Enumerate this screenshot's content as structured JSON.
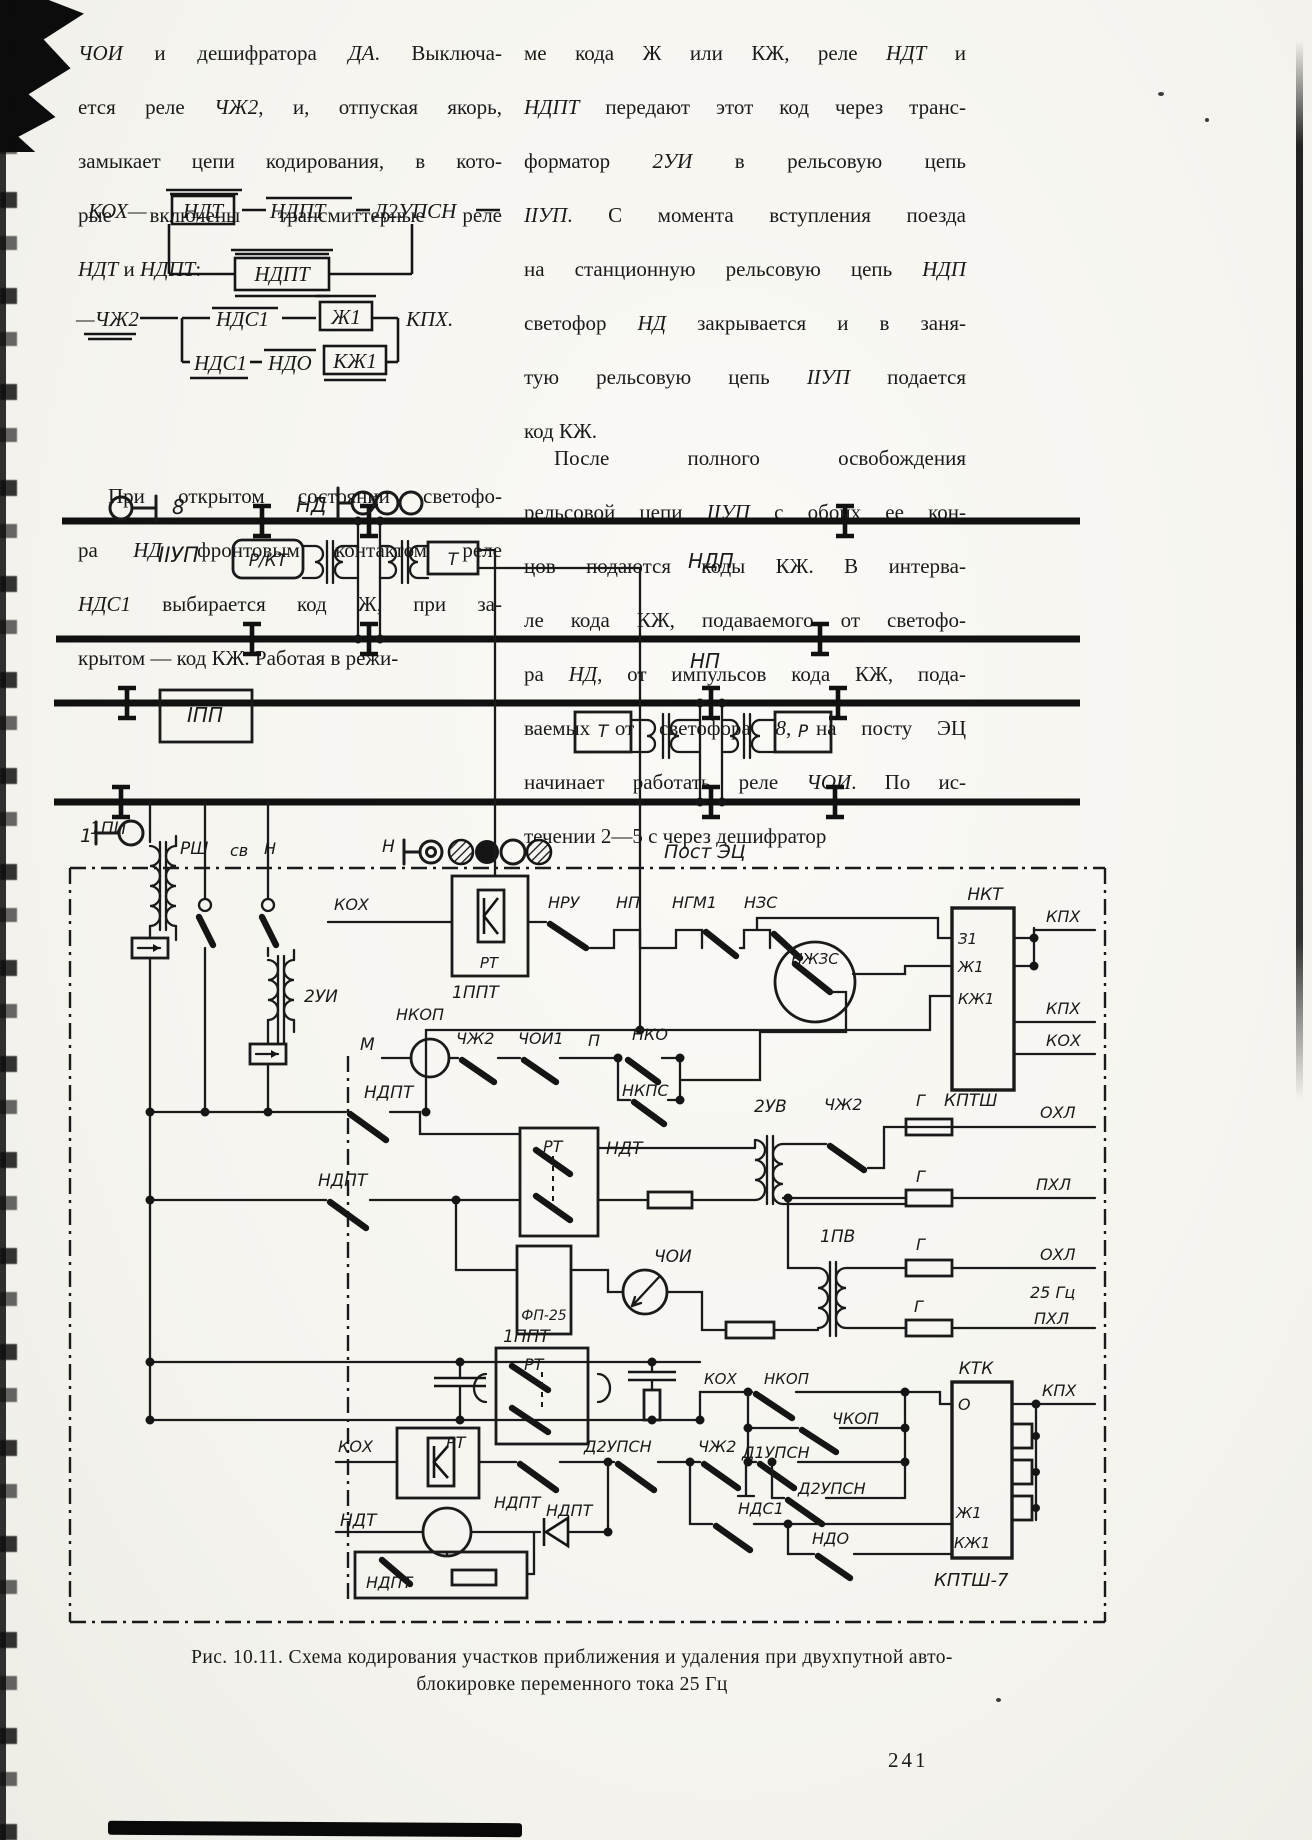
{
  "page": {
    "number": "241"
  },
  "caption": {
    "line1": "Рис. 10.11. Схема кодирования участков приближения и удаления при двухпутной авто-",
    "line2": "блокировке переменного тока 25 Гц"
  },
  "text": {
    "left": {
      "para1": [
        [
          [
            "ЧОИ",
            1
          ],
          [
            " и дешифратора ",
            0
          ],
          [
            "ДА",
            1
          ],
          [
            ". Выключа-",
            0
          ]
        ],
        [
          [
            "ется реле ",
            0
          ],
          [
            "ЧЖ2",
            1
          ],
          [
            ", и, отпуская якорь,",
            0
          ]
        ],
        [
          [
            "замыкает цепи кодирования, в кото-",
            0
          ]
        ],
        [
          [
            "рые включены трансмиттерные реле",
            0
          ]
        ],
        [
          [
            "НДТ",
            1
          ],
          [
            " и ",
            0
          ],
          [
            "НДПТ",
            1
          ],
          [
            ":",
            0
          ]
        ]
      ],
      "para2": [
        [
          [
            "При открытом состоянии светофо-",
            0
          ]
        ],
        [
          [
            "ра ",
            0
          ],
          [
            "НД",
            1
          ],
          [
            " фронтовым контактом реле",
            0
          ]
        ],
        [
          [
            "НДС1",
            1
          ],
          [
            " выбирается код Ж, при за-",
            0
          ]
        ],
        [
          [
            "крытом — код КЖ. Работая в режи-",
            0
          ]
        ]
      ]
    },
    "right": {
      "para1": [
        [
          [
            "ме кода Ж или КЖ, реле ",
            0
          ],
          [
            "НДТ",
            1
          ],
          [
            " и",
            0
          ]
        ],
        [
          [
            "НДПТ",
            1
          ],
          [
            " передают этот код через транс-",
            0
          ]
        ],
        [
          [
            "форматор ",
            0
          ],
          [
            "2УИ",
            1
          ],
          [
            " в рельсовую цепь",
            0
          ]
        ],
        [
          [
            "IIУП",
            1
          ],
          [
            ". С момента вступления поезда",
            0
          ]
        ],
        [
          [
            "на станционную рельсовую цепь ",
            0
          ],
          [
            "НДП",
            1
          ]
        ],
        [
          [
            "светофор ",
            0
          ],
          [
            "НД",
            1
          ],
          [
            " закрывается и в заня-",
            0
          ]
        ],
        [
          [
            "тую рельсовую цепь ",
            0
          ],
          [
            "IIУП",
            1
          ],
          [
            " подается",
            0
          ]
        ],
        [
          [
            "код КЖ.",
            0
          ]
        ]
      ],
      "para2": [
        [
          [
            "После полного освобождения",
            0
          ]
        ],
        [
          [
            "рельсовой цепи ",
            0
          ],
          [
            "IIУП",
            1
          ],
          [
            " с обоих ее кон-",
            0
          ]
        ],
        [
          [
            "цов подаются коды КЖ. В интерва-",
            0
          ]
        ],
        [
          [
            "ле кода КЖ, подаваемого от светофо-",
            0
          ]
        ],
        [
          [
            "ра ",
            0
          ],
          [
            "НД",
            1
          ],
          [
            ", от импульсов кода КЖ, пода-",
            0
          ]
        ],
        [
          [
            "ваемых от светофора ",
            0
          ],
          [
            "8",
            1
          ],
          [
            ", на посту ЭЦ",
            0
          ]
        ],
        [
          [
            "начинает работать реле ",
            0
          ],
          [
            "ЧОИ",
            1
          ],
          [
            ". По ис-",
            0
          ]
        ],
        [
          [
            "течении 2—5 с через дешифратор",
            0
          ]
        ]
      ]
    }
  },
  "formula": {
    "labels": [
      {
        "n": "f-kox",
        "t": "КОХ—",
        "x": 16,
        "y": 32,
        "s": 21
      },
      {
        "n": "f-ndt",
        "t": "НДТ",
        "x": 131,
        "y": 32,
        "s": 21,
        "a": "middle"
      },
      {
        "n": "f-ndpt",
        "t": "НДПТ",
        "x": 198,
        "y": 32,
        "s": 21
      },
      {
        "n": "f-d2upsn",
        "t": "Д2УПСН",
        "x": 302,
        "y": 32,
        "s": 21
      },
      {
        "n": "f-ndpt2",
        "t": "НДПТ",
        "x": 210,
        "y": 95,
        "s": 21,
        "a": "middle"
      },
      {
        "n": "f-chzh2",
        "t": "—ЧЖ2",
        "x": 4,
        "y": 140,
        "s": 21
      },
      {
        "n": "f-nds1",
        "t": "НДС1",
        "x": 144,
        "y": 140,
        "s": 21
      },
      {
        "n": "f-zh1",
        "t": "Ж1",
        "x": 274,
        "y": 138,
        "s": 21,
        "a": "middle"
      },
      {
        "n": "f-kpx",
        "t": "КПХ.",
        "x": 334,
        "y": 140,
        "s": 21
      },
      {
        "n": "f-nds1b",
        "t": "НДС1",
        "x": 122,
        "y": 184,
        "s": 21
      },
      {
        "n": "f-ndo",
        "t": "НДО",
        "x": 196,
        "y": 184,
        "s": 21
      },
      {
        "n": "f-kzh1",
        "t": "КЖ1",
        "x": 283,
        "y": 182,
        "s": 21,
        "a": "middle"
      }
    ]
  },
  "diagram": {
    "labels": [
      {
        "n": "signal-8-number",
        "t": "8",
        "x": 172,
        "y": 514,
        "s": 20
      },
      {
        "n": "signal-nd-name",
        "t": "НД",
        "x": 296,
        "y": 512,
        "s": 20
      },
      {
        "n": "track-2up-label",
        "t": "IIУП",
        "x": 158,
        "y": 562,
        "s": 21
      },
      {
        "n": "box-rkt-label",
        "t": "Р/КТ",
        "x": 268,
        "y": 566,
        "s": 17,
        "a": "middle"
      },
      {
        "n": "box-t2-label",
        "t": "Т",
        "x": 453,
        "y": 565,
        "s": 17,
        "a": "middle"
      },
      {
        "n": "track-ndp-label",
        "t": "НДП",
        "x": 688,
        "y": 568,
        "s": 20
      },
      {
        "n": "track-1pp-label",
        "t": "IПП",
        "x": 205,
        "y": 722,
        "s": 20,
        "a": "middle"
      },
      {
        "n": "box-t1-label",
        "t": "Т",
        "x": 603,
        "y": 737,
        "s": 17,
        "a": "middle"
      },
      {
        "n": "box-r1-label",
        "t": "Р",
        "x": 803,
        "y": 737,
        "s": 17,
        "a": "middle"
      },
      {
        "n": "track-np-label",
        "t": "НП",
        "x": 690,
        "y": 668,
        "s": 20
      },
      {
        "n": "signal-1-number",
        "t": "1",
        "x": 80,
        "y": 842,
        "s": 19
      },
      {
        "n": "cable-rsh-label",
        "t": "РШ",
        "x": 180,
        "y": 854,
        "s": 17
      },
      {
        "n": "cable-sv-label",
        "t": "св",
        "x": 230,
        "y": 856,
        "s": 16
      },
      {
        "n": "cable-n-label",
        "t": "Н",
        "x": 264,
        "y": 854,
        "s": 16
      },
      {
        "n": "signal-n-name",
        "t": "Н",
        "x": 382,
        "y": 852,
        "s": 17
      },
      {
        "n": "post-ec-label",
        "t": "Пост ЭЦ",
        "x": 664,
        "y": 858,
        "s": 19
      },
      {
        "n": "transformer-1pi-label",
        "t": "1ПИ",
        "x": 90,
        "y": 834,
        "s": 17
      },
      {
        "n": "transformer-2ui-label",
        "t": "2УИ",
        "x": 304,
        "y": 1002,
        "s": 17
      },
      {
        "n": "wire-kox-label",
        "t": "КОХ",
        "x": 334,
        "y": 910,
        "s": 16
      },
      {
        "n": "box-rt-label",
        "t": "РТ",
        "x": 489,
        "y": 968,
        "s": 15,
        "a": "middle"
      },
      {
        "n": "box-1ppt-label",
        "t": "1ППТ",
        "x": 452,
        "y": 998,
        "s": 17
      },
      {
        "n": "contact-nru-label",
        "t": "НРУ",
        "x": 548,
        "y": 908,
        "s": 16
      },
      {
        "n": "contact-np-label",
        "t": "НП",
        "x": 616,
        "y": 908,
        "s": 16
      },
      {
        "n": "contact-ngm1-label",
        "t": "НГМ1",
        "x": 672,
        "y": 908,
        "s": 16
      },
      {
        "n": "contact-nzs-label",
        "t": "НЗС",
        "x": 744,
        "y": 908,
        "s": 16
      },
      {
        "n": "relay-nzhzs-label",
        "t": "НЖЗС",
        "x": 815,
        "y": 964,
        "s": 15,
        "a": "middle"
      },
      {
        "n": "block-nkt-label",
        "t": "НКТ",
        "x": 985,
        "y": 900,
        "s": 17,
        "a": "middle"
      },
      {
        "n": "terminal-z1-label",
        "t": "З1",
        "x": 958,
        "y": 944,
        "s": 15
      },
      {
        "n": "terminal-zh1-label",
        "t": "Ж1",
        "x": 958,
        "y": 972,
        "s": 15
      },
      {
        "n": "terminal-kzh1-label",
        "t": "КЖ1",
        "x": 958,
        "y": 1004,
        "s": 15
      },
      {
        "n": "wire-kpx1-label",
        "t": "КПХ",
        "x": 1046,
        "y": 922,
        "s": 16
      },
      {
        "n": "wire-kpx2-label",
        "t": "КПХ",
        "x": 1046,
        "y": 1014,
        "s": 16
      },
      {
        "n": "wire-kox2-label",
        "t": "КОХ",
        "x": 1046,
        "y": 1046,
        "s": 16
      },
      {
        "n": "terminal-m-label",
        "t": "М",
        "x": 360,
        "y": 1050,
        "s": 17
      },
      {
        "n": "relay-nkop-label",
        "t": "НКОП",
        "x": 396,
        "y": 1020,
        "s": 16
      },
      {
        "n": "contact-chzh2-label",
        "t": "ЧЖ2",
        "x": 456,
        "y": 1044,
        "s": 16
      },
      {
        "n": "contact-choi1-label",
        "t": "ЧОИ1",
        "x": 518,
        "y": 1044,
        "s": 16
      },
      {
        "n": "terminal-p-label",
        "t": "П",
        "x": 588,
        "y": 1046,
        "s": 16
      },
      {
        "n": "contact-nko-label",
        "t": "НКО",
        "x": 632,
        "y": 1040,
        "s": 16
      },
      {
        "n": "contact-nkps-label",
        "t": "НКПС",
        "x": 622,
        "y": 1096,
        "s": 16
      },
      {
        "n": "contact-ndpt1-label",
        "t": "НДПТ",
        "x": 364,
        "y": 1098,
        "s": 17
      },
      {
        "n": "contact-ndpt2-label",
        "t": "НДПТ",
        "x": 318,
        "y": 1186,
        "s": 17
      },
      {
        "n": "box-rt2-label",
        "t": "РТ",
        "x": 543,
        "y": 1152,
        "s": 16
      },
      {
        "n": "wire-ndt-label",
        "t": "НДТ",
        "x": 606,
        "y": 1154,
        "s": 17
      },
      {
        "n": "transformer-2uv-label",
        "t": "2УВ",
        "x": 754,
        "y": 1112,
        "s": 17
      },
      {
        "n": "contact-chzh2b-label",
        "t": "ЧЖ2",
        "x": 824,
        "y": 1110,
        "s": 16
      },
      {
        "n": "fuse-g1-label",
        "t": "Г",
        "x": 916,
        "y": 1106,
        "s": 16
      },
      {
        "n": "block-kptsh-label",
        "t": "КПТШ",
        "x": 944,
        "y": 1106,
        "s": 17
      },
      {
        "n": "wire-oxl1-label",
        "t": "ОХЛ",
        "x": 1040,
        "y": 1118,
        "s": 16
      },
      {
        "n": "fuse-g2-label",
        "t": "Г",
        "x": 916,
        "y": 1182,
        "s": 16
      },
      {
        "n": "wire-pxl1-label",
        "t": "ПХЛ",
        "x": 1036,
        "y": 1190,
        "s": 16
      },
      {
        "n": "filter-fp25-label",
        "t": "ФП-25",
        "x": 544,
        "y": 1320,
        "s": 14,
        "a": "middle"
      },
      {
        "n": "relay-choi-label",
        "t": "ЧОИ",
        "x": 654,
        "y": 1262,
        "s": 17
      },
      {
        "n": "transformer-1pv-label",
        "t": "1ПВ",
        "x": 820,
        "y": 1242,
        "s": 17
      },
      {
        "n": "fuse-g3-label",
        "t": "Г",
        "x": 916,
        "y": 1250,
        "s": 16
      },
      {
        "n": "wire-oxl2-label",
        "t": "ОХЛ",
        "x": 1040,
        "y": 1260,
        "s": 16
      },
      {
        "n": "label-25hz",
        "t": "25 Гц",
        "x": 1030,
        "y": 1298,
        "s": 16
      },
      {
        "n": "fuse-g4-label",
        "t": "Г",
        "x": 914,
        "y": 1312,
        "s": 16
      },
      {
        "n": "wire-pxl2-label",
        "t": "ПХЛ",
        "x": 1034,
        "y": 1324,
        "s": 16
      },
      {
        "n": "box-1ppt2-label",
        "t": "1ППТ",
        "x": 503,
        "y": 1342,
        "s": 17
      },
      {
        "n": "box-rt3-label",
        "t": "РТ",
        "x": 524,
        "y": 1370,
        "s": 16
      },
      {
        "n": "wire-kox3-label",
        "t": "КОХ",
        "x": 338,
        "y": 1452,
        "s": 16
      },
      {
        "n": "box-rt4-label",
        "t": "РТ",
        "x": 446,
        "y": 1448,
        "s": 16
      },
      {
        "n": "contact-ndpt3-label",
        "t": "НДПТ",
        "x": 494,
        "y": 1508,
        "s": 16
      },
      {
        "n": "contact-d2upsn1-label",
        "t": "Д2УПСН",
        "x": 584,
        "y": 1452,
        "s": 16
      },
      {
        "n": "contact-chzh2c-label",
        "t": "ЧЖ2",
        "x": 698,
        "y": 1452,
        "s": 16
      },
      {
        "n": "wire-kox4-label",
        "t": "КОХ",
        "x": 704,
        "y": 1384,
        "s": 15
      },
      {
        "n": "contact-nkop2-label",
        "t": "НКОП",
        "x": 764,
        "y": 1384,
        "s": 15
      },
      {
        "n": "contact-chkop-label",
        "t": "ЧКОП",
        "x": 832,
        "y": 1424,
        "s": 16
      },
      {
        "n": "contact-d1upsn-label",
        "t": "Д1УПСН",
        "x": 742,
        "y": 1458,
        "s": 16
      },
      {
        "n": "contact-d2upsn2-label",
        "t": "Д2УПСН",
        "x": 798,
        "y": 1494,
        "s": 16
      },
      {
        "n": "contact-nds1-label",
        "t": "НДС1",
        "x": 738,
        "y": 1514,
        "s": 16
      },
      {
        "n": "contact-ndo-label",
        "t": "НДО",
        "x": 812,
        "y": 1544,
        "s": 16
      },
      {
        "n": "block-ktk-label",
        "t": "КТК",
        "x": 976,
        "y": 1374,
        "s": 17,
        "a": "middle"
      },
      {
        "n": "terminal-o-label",
        "t": "О",
        "x": 958,
        "y": 1410,
        "s": 16
      },
      {
        "n": "terminal-zh1b-label",
        "t": "Ж1",
        "x": 956,
        "y": 1518,
        "s": 15
      },
      {
        "n": "terminal-kzh1b-label",
        "t": "КЖ1",
        "x": 954,
        "y": 1548,
        "s": 15
      },
      {
        "n": "block-kptsh7-label",
        "t": "КПТШ-7",
        "x": 934,
        "y": 1586,
        "s": 18
      },
      {
        "n": "wire-kpx3-label",
        "t": "КПХ",
        "x": 1042,
        "y": 1396,
        "s": 16
      },
      {
        "n": "relay-ndt2-label",
        "t": "НДТ",
        "x": 340,
        "y": 1526,
        "s": 17
      },
      {
        "n": "contact-ndpt4-label",
        "t": "НДПТ",
        "x": 546,
        "y": 1516,
        "s": 16
      },
      {
        "n": "box-ndpt5-label",
        "t": "НДПТ",
        "x": 366,
        "y": 1588,
        "s": 16
      }
    ]
  }
}
